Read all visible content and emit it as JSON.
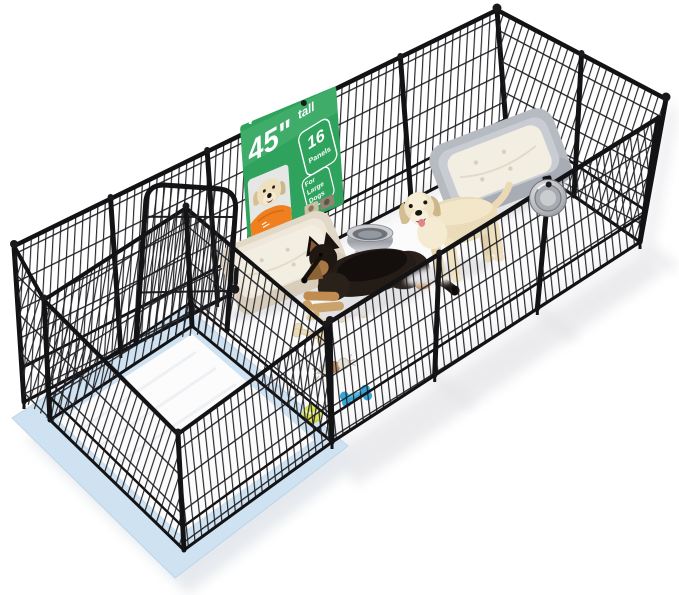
{
  "scene": {
    "type": "product-photo",
    "subject": "Black metal heavy-duty dog playpen (16 panels) with arched gate, two dogs, two dog beds, water bowls, toys and a blue training pad, on a white studio background",
    "background_color": "#ffffff"
  },
  "banner": {
    "background_color": "#2fa35d",
    "headline": "45\"",
    "headline_word": "tall",
    "panels_count": "16",
    "panels_label": "Panels",
    "audience_line1": "For",
    "audience_line2": "Large",
    "audience_line3": "Dogs"
  },
  "palette": {
    "fence_black": "#1b1b1d",
    "pee_pad_blue": "#cfe2f2",
    "pad_sheet_white": "#fcfcfd",
    "bed_left_shell": "#e2d8c8",
    "bed_right_shell": "#b6bac1",
    "cushion_cream": "#f3eee2",
    "shirt_orange": "#ef7f1f",
    "toy_bone_blue": "#33a6d6",
    "tennis_ball_yellow": "#d9e351",
    "steel_bowl_gray": "#9b9ea4"
  }
}
